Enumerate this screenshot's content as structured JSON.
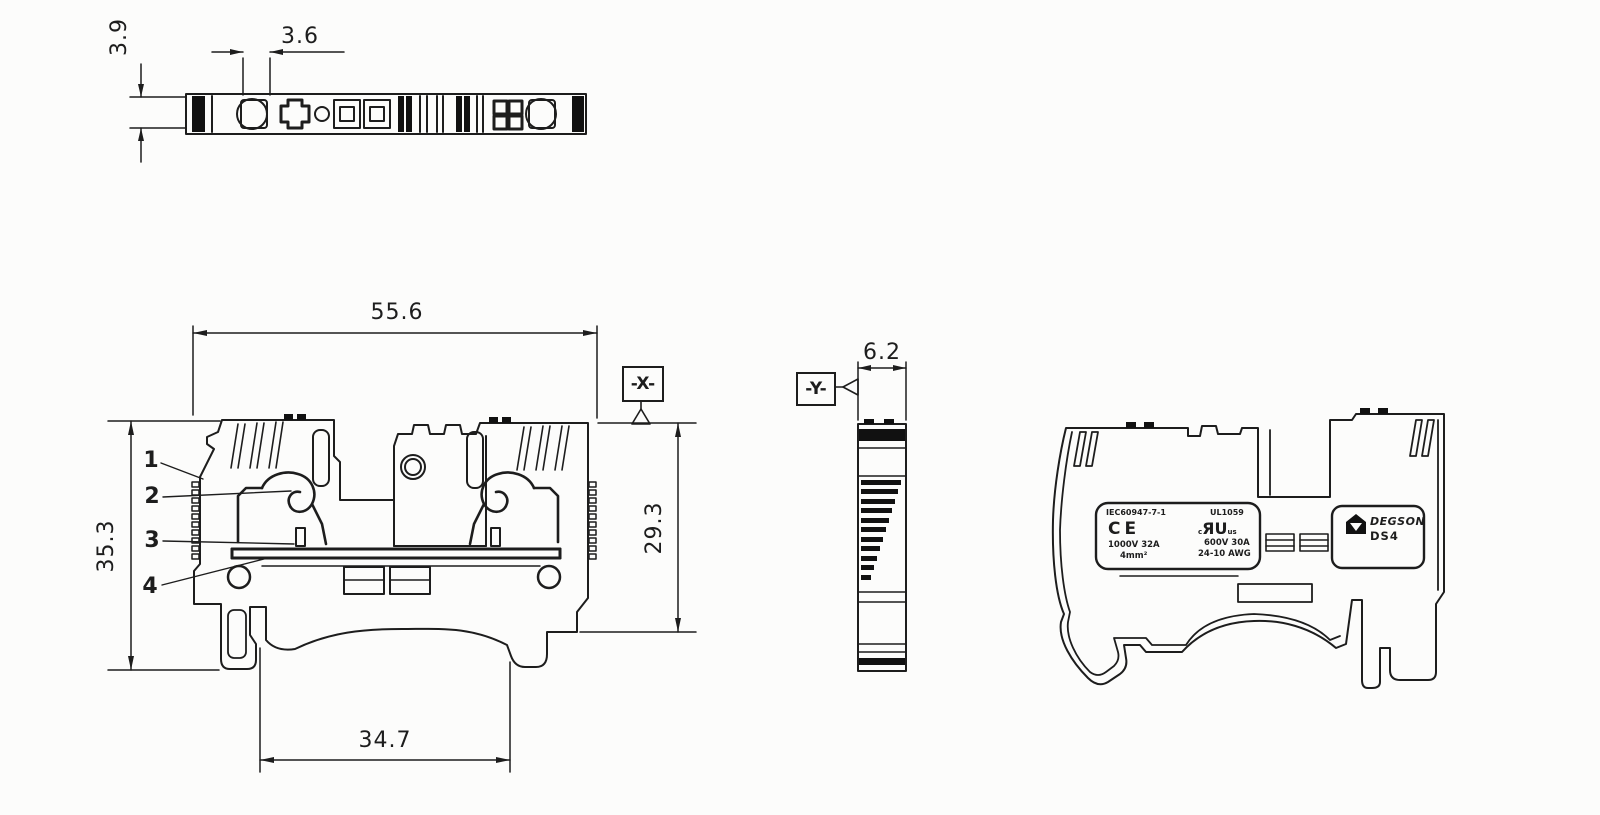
{
  "drawing": {
    "background": "#fcfcfb",
    "line_color": "#1d1d1d",
    "views": {
      "top_view": "terminal-block-top-view",
      "front_view": "terminal-block-front-section-view",
      "side_view": "terminal-block-side-profile-view",
      "elevation_view": "terminal-block-side-elevation-view"
    }
  },
  "dimensions": {
    "d39": "3.9",
    "d36": "3.6",
    "d556": "55.6",
    "d353": "35.3",
    "d293": "29.3",
    "d347": "34.7",
    "d62": "6.2"
  },
  "callouts": {
    "c1": "1",
    "c2": "2",
    "c3": "3",
    "c4": "4"
  },
  "datums": {
    "x": "-X-",
    "y": "-Y-"
  },
  "marking_label": {
    "standard_iec": "IEC60947-7-1",
    "standard_ul": "UL1059",
    "ce_mark": "CE",
    "ur_mark_c": "c",
    "ur_mark": "ЯU",
    "ur_mark_us": "us",
    "rating_iec": "1000V 32A",
    "wire_size_iec": "4mm²",
    "rating_ul": "600V 30A",
    "wire_size_ul": "24-10 AWG"
  },
  "brand_label": {
    "logo": "degson-triangle-logo",
    "brand": "DEGSON",
    "model": "DS4"
  }
}
